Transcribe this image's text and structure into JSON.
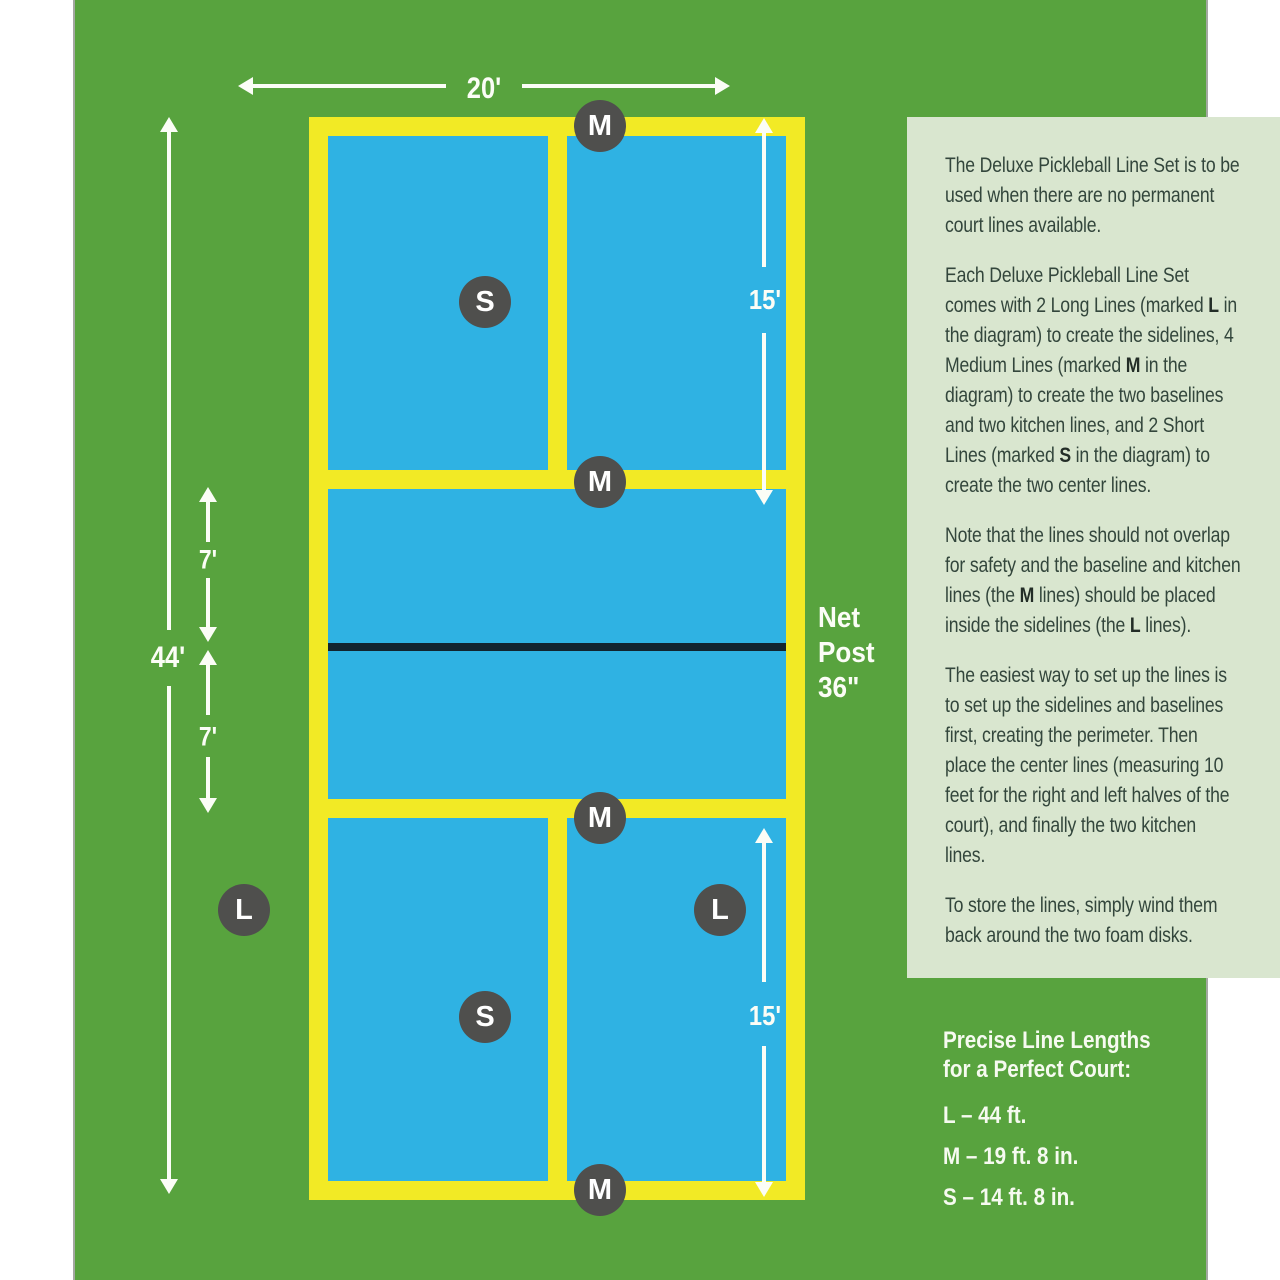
{
  "diagram": {
    "labels": {
      "court_width": "20'",
      "court_length": "44'",
      "service_depth_top": "15'",
      "service_depth_bottom": "15'",
      "kitchen_depth_top": "7'",
      "kitchen_depth_bottom": "7'"
    },
    "net_post": {
      "line1": "Net",
      "line2": "Post",
      "line3": "36\""
    },
    "markers": [
      {
        "label": "M"
      },
      {
        "label": "S"
      },
      {
        "label": "M"
      },
      {
        "label": "M"
      },
      {
        "label": "L"
      },
      {
        "label": "L"
      },
      {
        "label": "S"
      },
      {
        "label": "M"
      }
    ]
  },
  "instructions": {
    "paragraphs": [
      [
        {
          "t": "The Deluxe Pickleball Line Set is to be used when there are no permanent court lines available."
        }
      ],
      [
        {
          "t": "Each Deluxe Pickleball Line Set comes with 2 Long Lines (marked "
        },
        {
          "t": "L",
          "b": true
        },
        {
          "t": " in the diagram) to create the sidelines, 4 Medium Lines  (marked "
        },
        {
          "t": "M",
          "b": true
        },
        {
          "t": " in the diagram) to create the two baselines and two kitchen lines, and 2 Short Lines (marked "
        },
        {
          "t": "S",
          "b": true
        },
        {
          "t": " in the diagram) to create the two center lines."
        }
      ],
      [
        {
          "t": "Note that the lines should not overlap for safety and the baseline and kitchen lines (the "
        },
        {
          "t": "M",
          "b": true
        },
        {
          "t": " lines) should be placed inside the sidelines (the "
        },
        {
          "t": "L",
          "b": true
        },
        {
          "t": " lines)."
        }
      ],
      [
        {
          "t": "The easiest way to set up the lines is to set up the sidelines and baselines first, creating the perimeter. Then place the center lines (measuring 10 feet for the right and left halves of the court), and finally the two kitchen lines."
        }
      ],
      [
        {
          "t": "To store the lines, simply wind them back around the two foam disks."
        }
      ]
    ]
  },
  "line_lengths": {
    "heading_line1": "Precise Line Lengths",
    "heading_line2": "for a Perfect Court:",
    "items": [
      {
        "text": "L – 44 ft."
      },
      {
        "text": "M – 19 ft. 8 in."
      },
      {
        "text": "S – 14 ft. 8 in."
      }
    ]
  },
  "colors": {
    "poster_green": "#58a33e",
    "court_blue": "#2fb2e3",
    "line_yellow": "#f2ea25",
    "marker_gray": "#4f4f4d",
    "net_dark": "#12242f",
    "panel_background": "#d9e6cf",
    "panel_text": "#33463c",
    "white": "#ffffff"
  }
}
